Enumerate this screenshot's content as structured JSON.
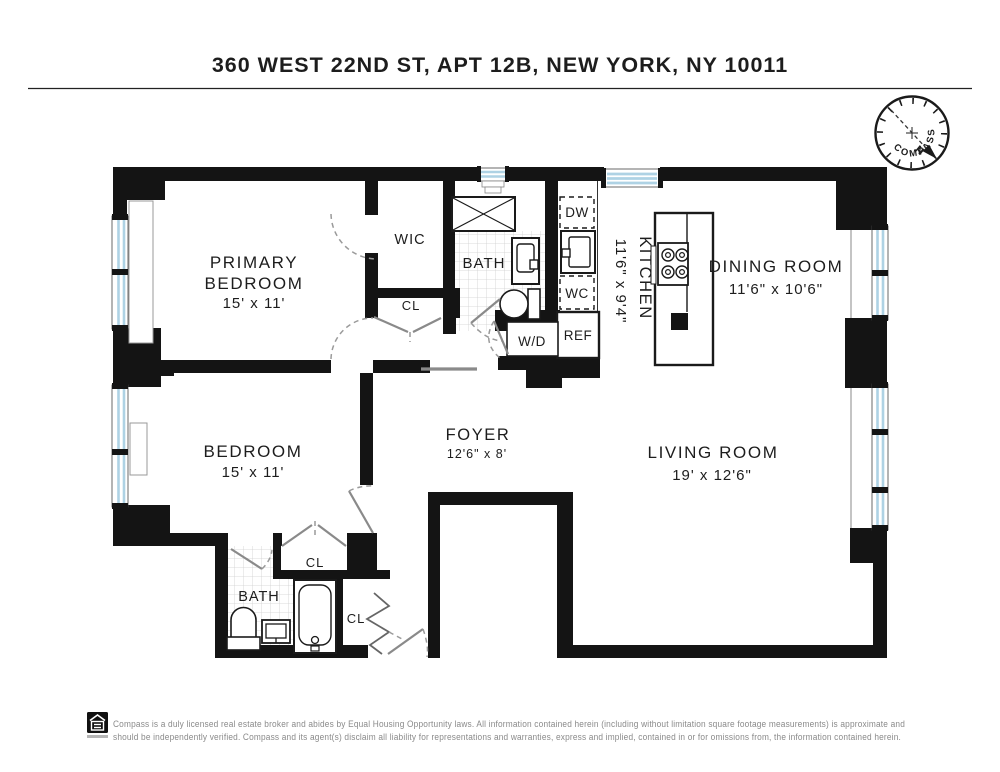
{
  "header": {
    "title": "360 WEST 22ND ST, APT 12B, NEW YORK, NY 10011"
  },
  "compass": {
    "label": "COMPASS",
    "north_label": "N",
    "north_color": "#c0392b"
  },
  "floorplan": {
    "rooms": {
      "primary_bedroom": {
        "line1": "PRIMARY",
        "line2": "BEDROOM",
        "dims": "15' x 11'"
      },
      "bedroom": {
        "name": "BEDROOM",
        "dims": "15' x 11'"
      },
      "wic": {
        "name": "WIC"
      },
      "bath_upper": {
        "name": "BATH"
      },
      "bath_lower": {
        "name": "BATH"
      },
      "closet_hall": {
        "name": "CL"
      },
      "closet_bedroom": {
        "name": "CL"
      },
      "closet_entry": {
        "name": "CL"
      },
      "kitchen": {
        "name": "KITCHEN",
        "dims": "11'6\" x 9'4\""
      },
      "dining_room": {
        "name": "DINING ROOM",
        "dims": "11'6\" x 10'6\""
      },
      "living_room": {
        "name": "LIVING ROOM",
        "dims": "19' x 12'6\""
      },
      "foyer": {
        "name": "FOYER",
        "dims": "12'6\" x 8'"
      }
    },
    "appliances": {
      "dishwasher": "DW",
      "water_closet": "WC",
      "refrigerator": "REF",
      "washer_dryer": "W/D"
    },
    "window_color": "#aed2e4"
  },
  "footer": {
    "logo": "Equal Housing Opportunity",
    "disclaimer_line1": "Compass is a duly licensed real estate broker and abides by Equal Housing Opportunity laws. All information contained herein (including without limitation square footage measurements) is approximate and",
    "disclaimer_line2": "should be independently verified. Compass and its agent(s) disclaim all liability for representations and warranties, express and implied, contained in or for omissions from, the information contained herein."
  }
}
